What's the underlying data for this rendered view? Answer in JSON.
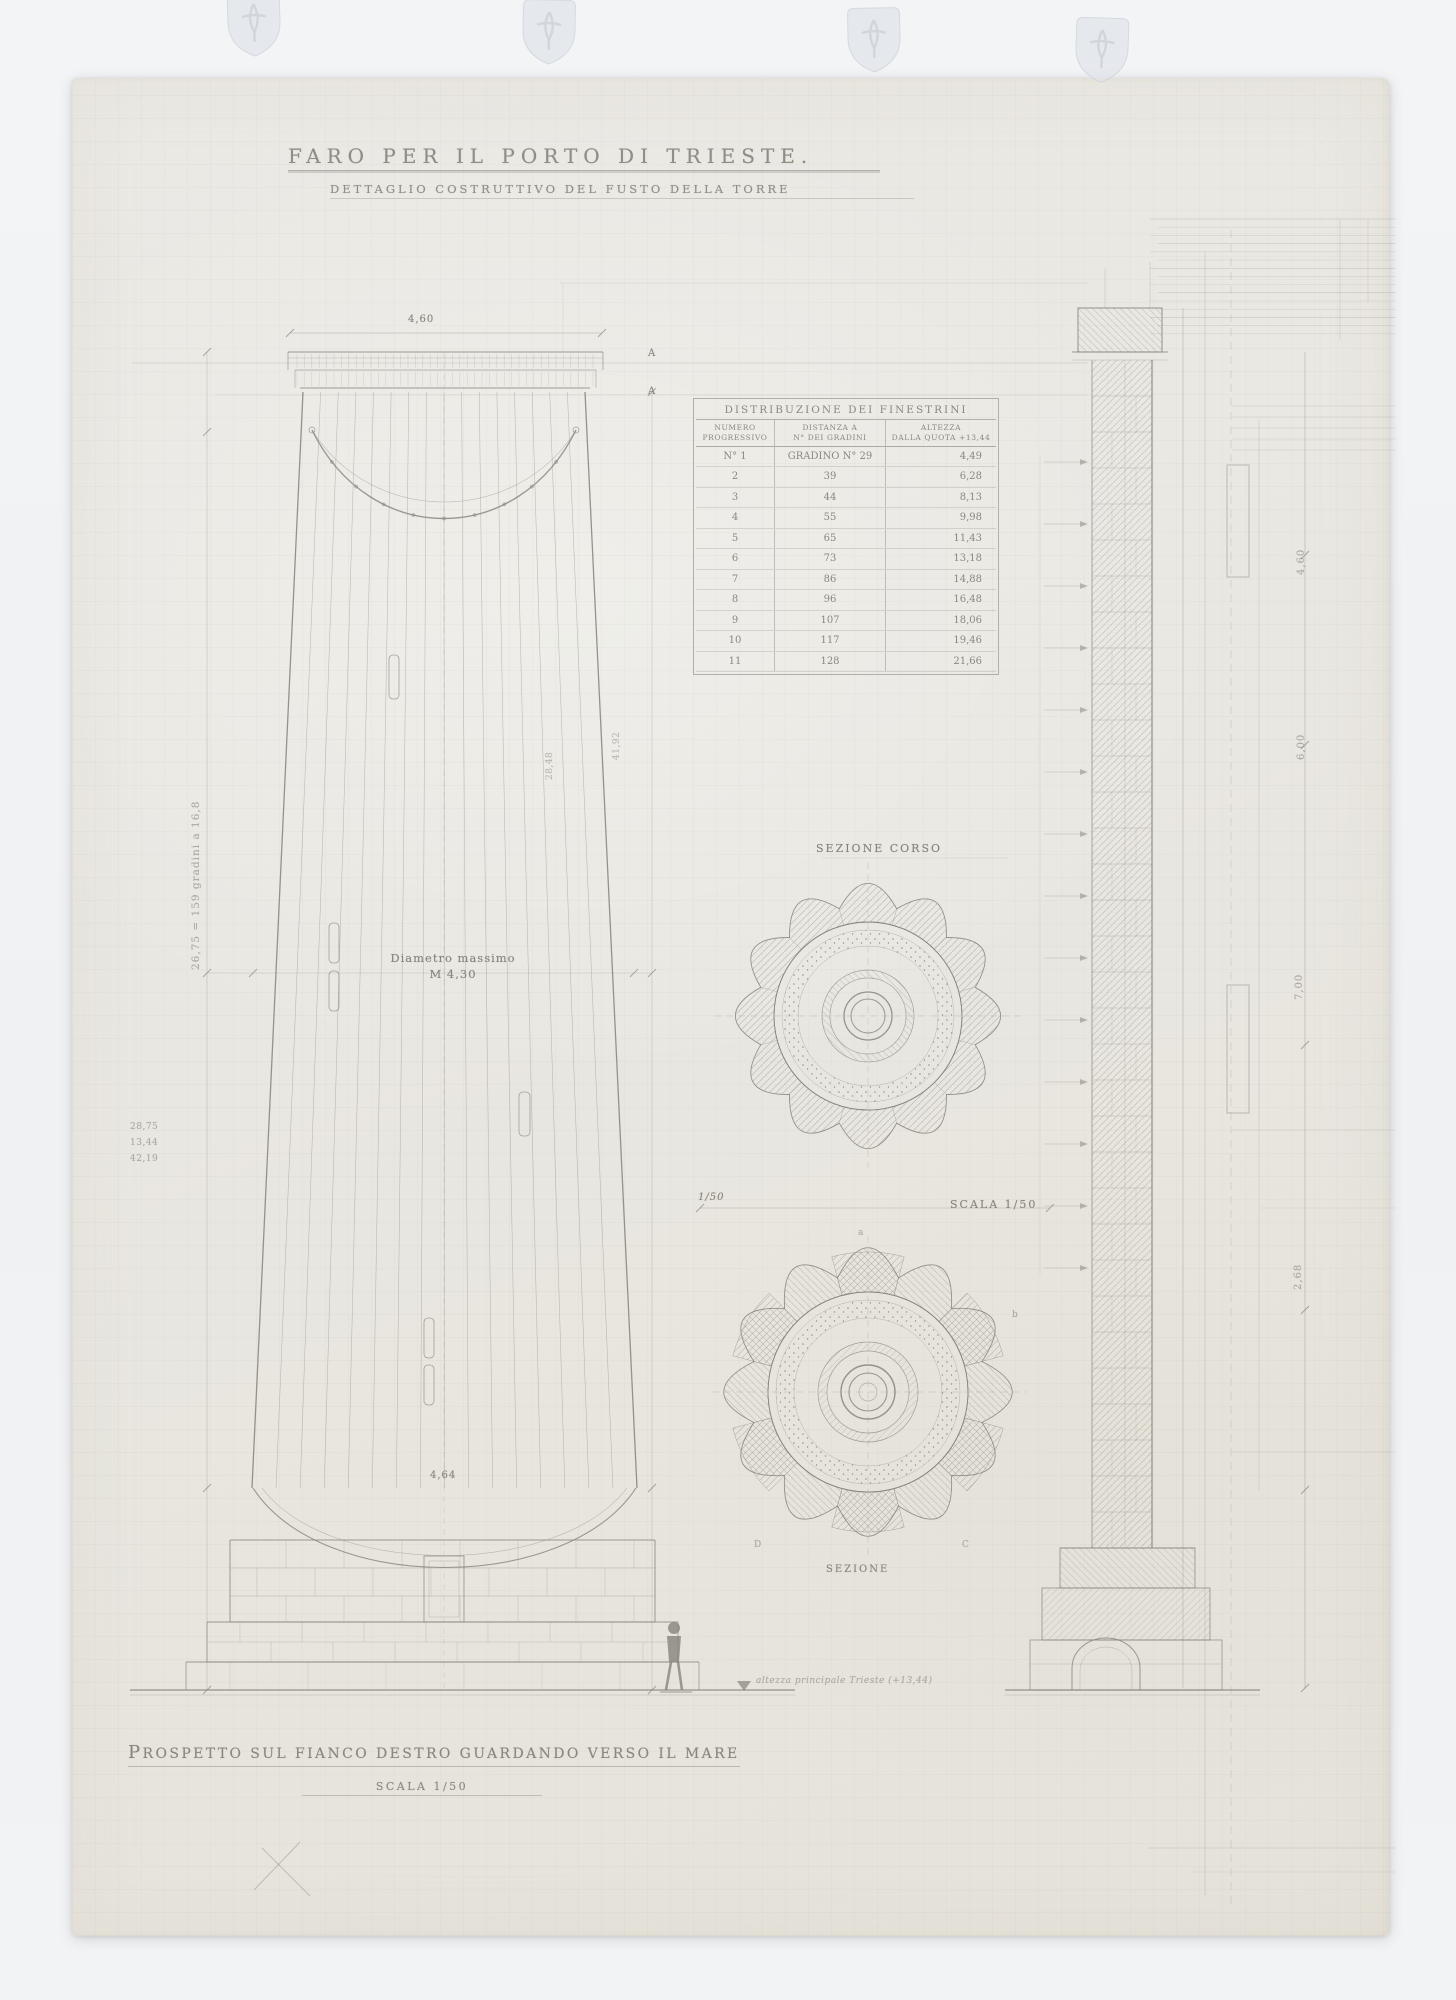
{
  "palette": {
    "background": "#eef0f2",
    "paper": "#e9e7e1",
    "pencil": "#86837a",
    "ink_text": "#8a877e"
  },
  "title": {
    "main": "FARO PER IL PORTO DI TRIESTE.",
    "subtitle": "DETTAGLIO COSTRUTTIVO DEL FUSTO DELLA TORRE"
  },
  "table": {
    "title": "DISTRIBUZIONE DEI FINESTRINI",
    "headers": [
      [
        "NUMERO",
        "PROGRESSIVO"
      ],
      [
        "DISTANZA A",
        "N° DEI GRADINI"
      ],
      [
        "ALTEZZA",
        "DALLA QUOTA +13,44"
      ]
    ],
    "rows": [
      [
        "N° 1",
        "GRADINO N° 29",
        "4,49"
      ],
      [
        "2",
        "39",
        "6,28"
      ],
      [
        "3",
        "44",
        "8,13"
      ],
      [
        "4",
        "55",
        "9,98"
      ],
      [
        "5",
        "65",
        "11,43"
      ],
      [
        "6",
        "73",
        "13,18"
      ],
      [
        "7",
        "86",
        "14,88"
      ],
      [
        "8",
        "96",
        "16,48"
      ],
      [
        "9",
        "107",
        "18,06"
      ],
      [
        "10",
        "117",
        "19,46"
      ],
      [
        "11",
        "128",
        "21,66"
      ]
    ]
  },
  "elevation": {
    "top_width_dim": "4,60",
    "diameter_label": "Diametro massimo",
    "diameter_value": "M 4,30",
    "base_dim": "4,64",
    "steps_annotation": "26,75 = 159 gradini a 16,8",
    "margin_numbers": [
      "28,75",
      "13,44",
      "42,19"
    ],
    "right_annotation_a": "28,48",
    "right_annotation_b": "41,92",
    "section_marker_top": "A",
    "section_marker_bottom": "A",
    "sea_level_note": "altezza principale Trieste (+13,44)"
  },
  "plans": {
    "upper_label": "SEZIONE CORSO",
    "lower_label": "SEZIONE",
    "scale_note_left": "1/50",
    "scale_note_right": "SCALA 1/50",
    "letters": {
      "top": "a",
      "right": "b",
      "bottom_right": "C",
      "bottom_left": "D"
    }
  },
  "wall_section": {
    "dim_1": "4,60",
    "dim_2": "6,00",
    "dim_3": "7,00",
    "dim_4": "2,68"
  },
  "caption": {
    "line1": "PROSPETTO SUL FIANCO DESTRO GUARDANDO VERSO IL MARE",
    "line2": "SCALA 1/50"
  }
}
